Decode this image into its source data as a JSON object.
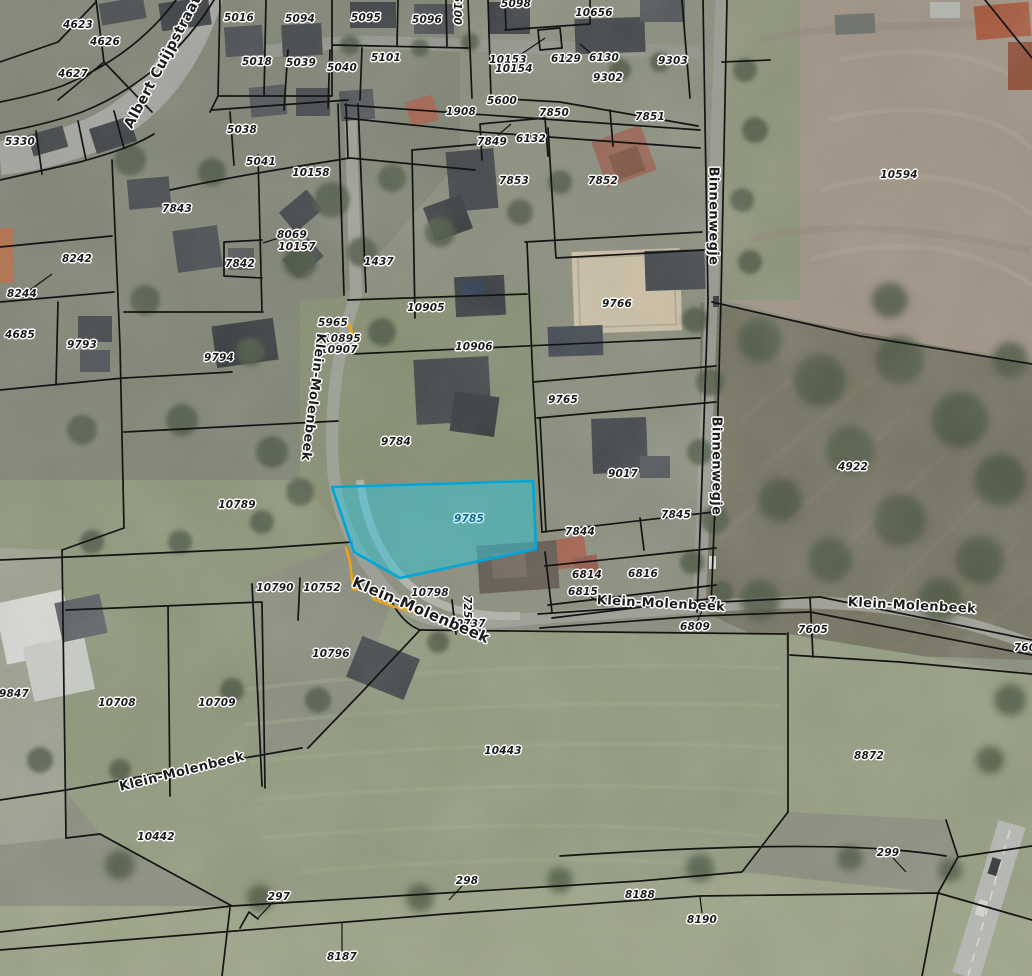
{
  "map": {
    "boundary_color": "#141414",
    "label_text_color": "#191919",
    "selected_parcel": {
      "label": "9785",
      "points": "332,487 533,481 536,549 400,578 354,552",
      "fill_color": "#2fc5dc",
      "fill_opacity": 0.5,
      "stroke_color": "#00a6d8",
      "label_color": "#0b6b8d",
      "label_x": 469,
      "label_y": 519
    },
    "measurement_path": {
      "color": "#e9a41c",
      "d": "M346,548 L350,562 L353,589 L371,591 L374,599 C395,608 418,614 440,618 L468,623"
    },
    "marker_tick": {
      "color": "#e9a41c",
      "d": "M349,324 L353,336"
    },
    "parcel_labels": [
      {
        "t": "4623",
        "x": 78,
        "y": 25
      },
      {
        "t": "4626",
        "x": 105,
        "y": 42
      },
      {
        "t": "4627",
        "x": 73,
        "y": 74
      },
      {
        "t": "5330",
        "x": 20,
        "y": 142
      },
      {
        "t": "5016",
        "x": 239,
        "y": 18
      },
      {
        "t": "5094",
        "x": 300,
        "y": 19
      },
      {
        "t": "5095",
        "x": 366,
        "y": 18
      },
      {
        "t": "5096",
        "x": 427,
        "y": 20
      },
      {
        "t": "5100",
        "x": 457,
        "y": 10,
        "r": 90
      },
      {
        "t": "5098",
        "x": 516,
        "y": 4
      },
      {
        "t": "10656",
        "x": 594,
        "y": 13
      },
      {
        "t": "5018",
        "x": 257,
        "y": 62
      },
      {
        "t": "5039",
        "x": 301,
        "y": 63
      },
      {
        "t": "5040",
        "x": 342,
        "y": 68
      },
      {
        "t": "5101",
        "x": 386,
        "y": 58
      },
      {
        "t": "10153",
        "x": 508,
        "y": 60
      },
      {
        "t": "10154",
        "x": 514,
        "y": 69
      },
      {
        "t": "6129",
        "x": 566,
        "y": 59
      },
      {
        "t": "6130",
        "x": 604,
        "y": 58
      },
      {
        "t": "9302",
        "x": 608,
        "y": 78
      },
      {
        "t": "9303",
        "x": 673,
        "y": 61
      },
      {
        "t": "5038",
        "x": 242,
        "y": 130
      },
      {
        "t": "5041",
        "x": 261,
        "y": 162
      },
      {
        "t": "10158",
        "x": 311,
        "y": 173
      },
      {
        "t": "1908",
        "x": 461,
        "y": 112
      },
      {
        "t": "5600",
        "x": 502,
        "y": 101
      },
      {
        "t": "7850",
        "x": 554,
        "y": 113
      },
      {
        "t": "7851",
        "x": 650,
        "y": 117
      },
      {
        "t": "7849",
        "x": 492,
        "y": 142
      },
      {
        "t": "6132",
        "x": 531,
        "y": 139
      },
      {
        "t": "7853",
        "x": 514,
        "y": 181
      },
      {
        "t": "7852",
        "x": 603,
        "y": 181
      },
      {
        "t": "10594",
        "x": 899,
        "y": 175
      },
      {
        "t": "7843",
        "x": 177,
        "y": 209
      },
      {
        "t": "8069",
        "x": 292,
        "y": 235
      },
      {
        "t": "10157",
        "x": 297,
        "y": 247
      },
      {
        "t": "7842",
        "x": 240,
        "y": 264
      },
      {
        "t": "8242",
        "x": 77,
        "y": 259
      },
      {
        "t": "8244",
        "x": 22,
        "y": 294
      },
      {
        "t": "1437",
        "x": 379,
        "y": 262
      },
      {
        "t": "4685",
        "x": 20,
        "y": 335
      },
      {
        "t": "9793",
        "x": 82,
        "y": 345
      },
      {
        "t": "9794",
        "x": 219,
        "y": 358
      },
      {
        "t": "5965",
        "x": 333,
        "y": 323
      },
      {
        "t": "10895",
        "x": 342,
        "y": 339
      },
      {
        "t": "10907",
        "x": 339,
        "y": 350
      },
      {
        "t": "10905",
        "x": 426,
        "y": 308
      },
      {
        "t": "10906",
        "x": 474,
        "y": 347
      },
      {
        "t": "9766",
        "x": 617,
        "y": 304
      },
      {
        "t": "9765",
        "x": 563,
        "y": 400
      },
      {
        "t": "9784",
        "x": 396,
        "y": 442
      },
      {
        "t": "9017",
        "x": 623,
        "y": 474
      },
      {
        "t": "4922",
        "x": 853,
        "y": 467
      },
      {
        "t": "10789",
        "x": 237,
        "y": 505
      },
      {
        "t": "7845",
        "x": 676,
        "y": 515
      },
      {
        "t": "7844",
        "x": 580,
        "y": 532
      },
      {
        "t": "6814",
        "x": 587,
        "y": 575
      },
      {
        "t": "6816",
        "x": 643,
        "y": 574
      },
      {
        "t": "6815",
        "x": 583,
        "y": 592
      },
      {
        "t": "10790",
        "x": 275,
        "y": 588
      },
      {
        "t": "10752",
        "x": 322,
        "y": 588
      },
      {
        "t": "10798",
        "x": 430,
        "y": 593
      },
      {
        "t": "7251",
        "x": 467,
        "y": 611,
        "r": 90
      },
      {
        "t": "10737",
        "x": 467,
        "y": 624
      },
      {
        "t": "7",
        "x": 712,
        "y": 602
      },
      {
        "t": "6809",
        "x": 695,
        "y": 627
      },
      {
        "t": "7605",
        "x": 813,
        "y": 630
      },
      {
        "t": "760",
        "x": 1025,
        "y": 648
      },
      {
        "t": "10796",
        "x": 331,
        "y": 654
      },
      {
        "t": "9847",
        "x": 14,
        "y": 694
      },
      {
        "t": "10708",
        "x": 117,
        "y": 703
      },
      {
        "t": "10709",
        "x": 217,
        "y": 703
      },
      {
        "t": "10443",
        "x": 503,
        "y": 751
      },
      {
        "t": "8872",
        "x": 869,
        "y": 756
      },
      {
        "t": "10442",
        "x": 156,
        "y": 837
      },
      {
        "t": "299",
        "x": 888,
        "y": 853
      },
      {
        "t": "298",
        "x": 467,
        "y": 881
      },
      {
        "t": "297",
        "x": 279,
        "y": 897
      },
      {
        "t": "8188",
        "x": 640,
        "y": 895
      },
      {
        "t": "8190",
        "x": 702,
        "y": 920
      },
      {
        "t": "8187",
        "x": 342,
        "y": 957
      }
    ],
    "street_labels": [
      {
        "t": "Albert Cuijpstraat",
        "x": 163,
        "y": 62,
        "r": -62,
        "fs": 14
      },
      {
        "t": "Klein-Molenbeek",
        "x": 313,
        "y": 397,
        "r": 97,
        "fs": 13
      },
      {
        "t": "Klein-Molenbeek",
        "x": 421,
        "y": 610,
        "r": 23,
        "fs": 15
      },
      {
        "t": "Klein-Molenbeek",
        "x": 661,
        "y": 604,
        "r": 3,
        "fs": 13
      },
      {
        "t": "Klein-Molenbeek",
        "x": 912,
        "y": 606,
        "r": 3,
        "fs": 13
      },
      {
        "t": "Klein-Molenbeek",
        "x": 182,
        "y": 772,
        "r": -14,
        "fs": 13
      },
      {
        "t": "Binnenwegje",
        "x": 713,
        "y": 216,
        "r": 90,
        "fs": 13
      },
      {
        "t": "Binnenwegje",
        "x": 716,
        "y": 466,
        "r": 90,
        "fs": 13
      }
    ],
    "leader_lines": [
      [
        594,
        56,
        580,
        44
      ],
      [
        520,
        55,
        545,
        38
      ],
      [
        497,
        136,
        511,
        124
      ],
      [
        282,
        237,
        263,
        243
      ],
      [
        30,
        290,
        52,
        274
      ],
      [
        591,
        597,
        604,
        606
      ],
      [
        697,
        622,
        702,
        611
      ],
      [
        893,
        858,
        906,
        872
      ],
      [
        462,
        886,
        449,
        900
      ],
      [
        273,
        902,
        258,
        918
      ],
      [
        702,
        913,
        700,
        897
      ],
      [
        342,
        951,
        342,
        922
      ]
    ]
  }
}
